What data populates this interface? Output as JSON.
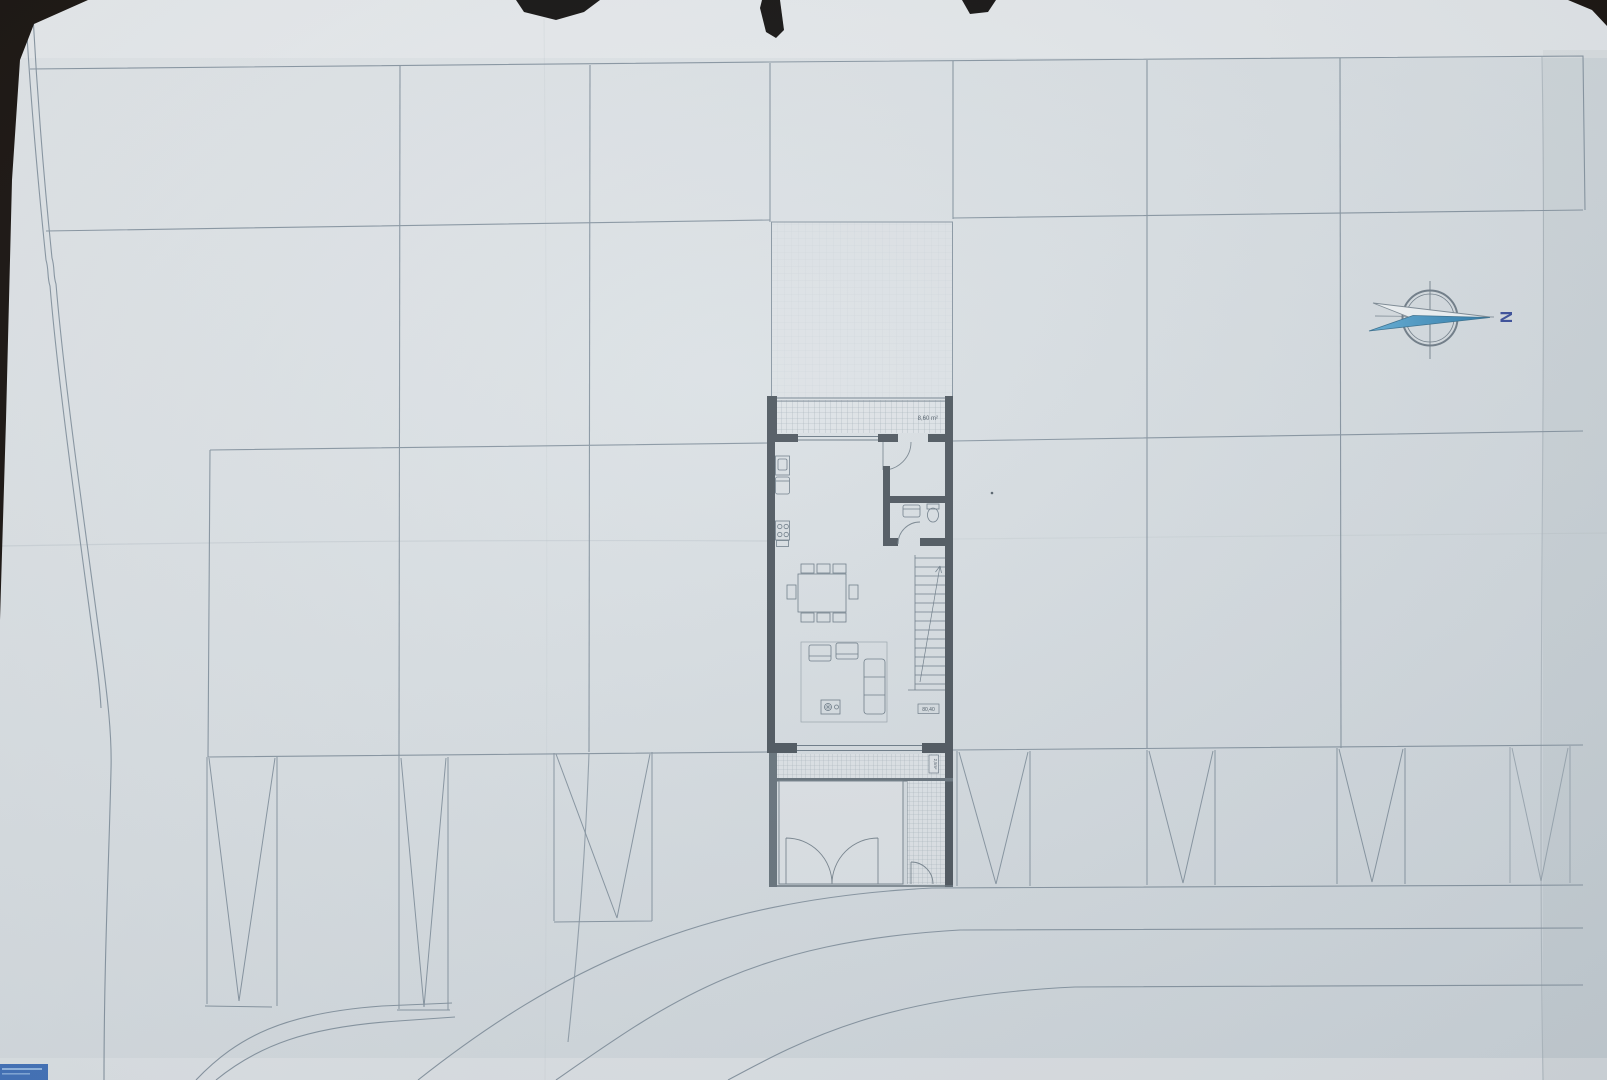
{
  "document": {
    "kind": "architectural site plan photo",
    "sheet": "ground floor unit in row of parcels, photographed on dark surface"
  },
  "compass": {
    "north_label": "N"
  },
  "floor_plan": {
    "terrace_area_label": "8,60 m²",
    "living_area_label": "80,40",
    "entry_area_label": "2,5m²"
  },
  "colors": {
    "background": "#17110d",
    "paper": "#d9dfe3",
    "parcel_line": "#8795a1",
    "wall_dark": "#4d565e",
    "wall_medium": "#67737c",
    "needle_blue": "#3f87b5",
    "north_letter_blue": "#3b4f9b",
    "sticker_blue": "#4373ba"
  }
}
